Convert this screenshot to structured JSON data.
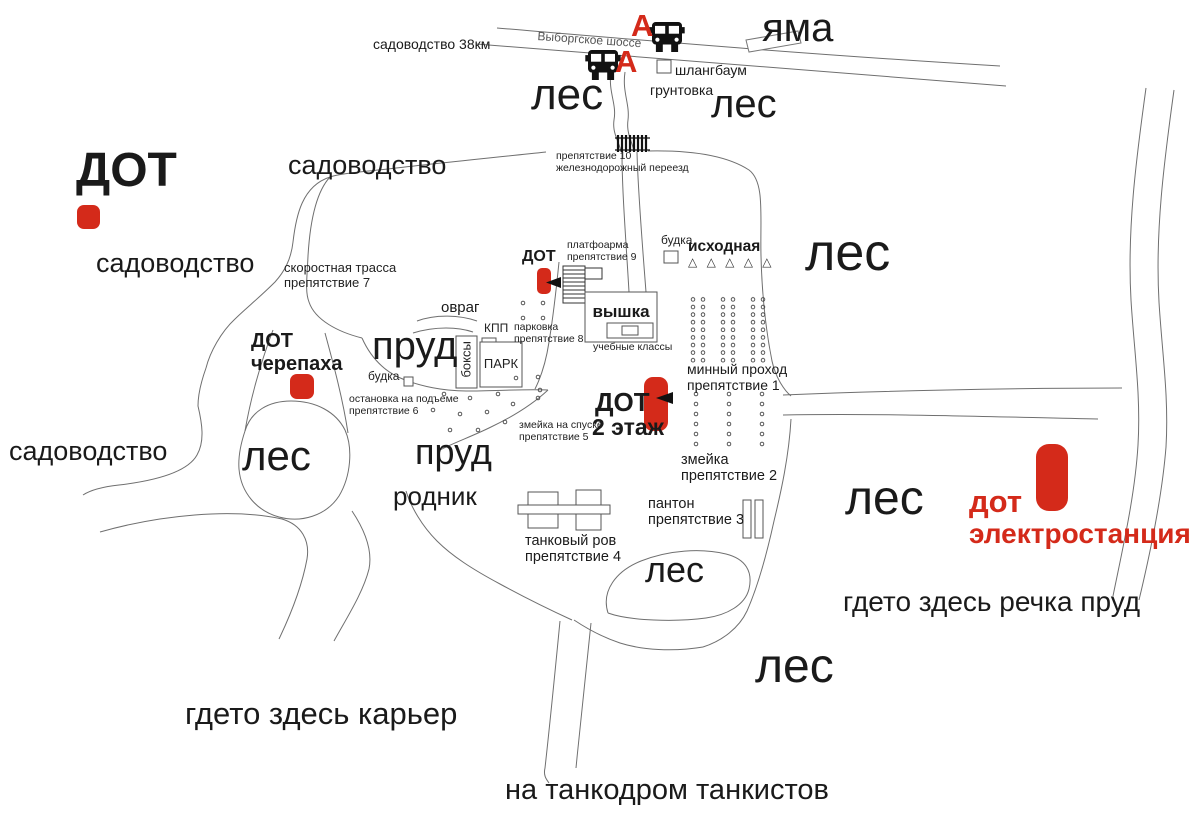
{
  "colors": {
    "red": "#d42a1a",
    "line": "#6a6a6a",
    "ink": "#1a1a1a",
    "structure": "#555555"
  },
  "L": {
    "sad_38": "садоводство 38км",
    "vyborg": "Выборгское шоссе",
    "bus_a1": "А",
    "bus_a2": "А",
    "shlang": "шлангбаум",
    "grunt": "грунтовка",
    "yama": "яма",
    "les_topleft": "лес",
    "les_topright": "лес",
    "dot_topleft": "ДОТ",
    "sad_top": "садоводство",
    "sad_left": "садоводство",
    "sad_bottomleft": "садоводство",
    "prep10": "препятствие 10\nжелезнодорожный переезд",
    "les_right": "лес",
    "skorost": "скоростная трасса\nпрепятствие 7",
    "platforma": "платфоарма\nпрепятствие 9",
    "budka1": "будка",
    "iskhodnaya": "исходная",
    "triangles": "△ △ △ △ △",
    "dot_center": "ДОТ",
    "ovrag": "овраг",
    "kpp": "КПП",
    "vyshka": "вышка",
    "ucheb": "учебные классы",
    "parkovka": "парковка\nпрепятствие 8",
    "park": "ПАРК",
    "boksy": "боксы",
    "prud1": "пруд",
    "dot_cher": "ДОТ\nчерепаха",
    "budka2": "будка",
    "ostanovka": "остановка на подъеме\nпрепятствие 6",
    "zmeika5": "змейка на спуске\nпрепятствие 5",
    "dot2": "ДОТ",
    "dot2_floor": "2 этаж",
    "minny": "минный проход\nпрепятствие 1",
    "zmeika2": "змейка\nпрепятствие 2",
    "les_oval": "лес",
    "prud2": "пруд",
    "rodnik": "родник",
    "ponton": "пантон\nпрепятствие 3",
    "tankrov": "танковый ров\nпрепятствие 4",
    "les_midright": "лес",
    "dot_el_1": "дот",
    "dot_el_2": "электростанция",
    "les_south": "лес",
    "rechka": "гдето здесь речка пруд",
    "les_bottom": "лес",
    "karier": "гдето здесь карьер",
    "tankodrom": "на танкодром танкистов"
  }
}
